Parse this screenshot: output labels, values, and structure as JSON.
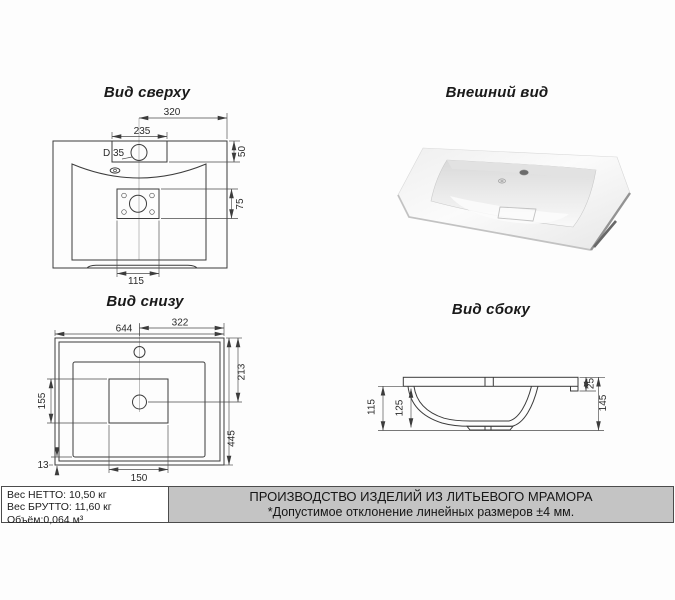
{
  "titles": {
    "top": "Вид сверху",
    "external": "Внешний вид",
    "bottom": "Вид снизу",
    "side": "Вид сбоку"
  },
  "top_view": {
    "dim_320": "320",
    "dim_235": "235",
    "dim_hole": "D 35",
    "dim_50": "50",
    "dim_75": "75",
    "dim_115": "115"
  },
  "bottom_view": {
    "dim_644": "644",
    "dim_322": "322",
    "dim_213": "213",
    "dim_445": "445",
    "dim_155": "155",
    "dim_13": "13",
    "dim_150": "150"
  },
  "side_view": {
    "dim_115": "115",
    "dim_125": "125",
    "dim_25": "25",
    "dim_145": "145"
  },
  "footer": {
    "net": "Вес НЕТТО: 10,50 кг",
    "gross": "Вес БРУТТО: 11,60 кг",
    "volume": "Объём:0,064 м³",
    "line1": "ПРОИЗВОДСТВО ИЗДЕЛИЙ ИЗ ЛИТЬЕВОГО МРАМОРА",
    "line2": "*Допустимое отклонение линейных размеров ±4 мм."
  },
  "colors": {
    "paper": "#fdfdfd",
    "line": "#3c3c3c",
    "footer_gray": "#c4c4c4",
    "border": "#4c4c4c"
  }
}
